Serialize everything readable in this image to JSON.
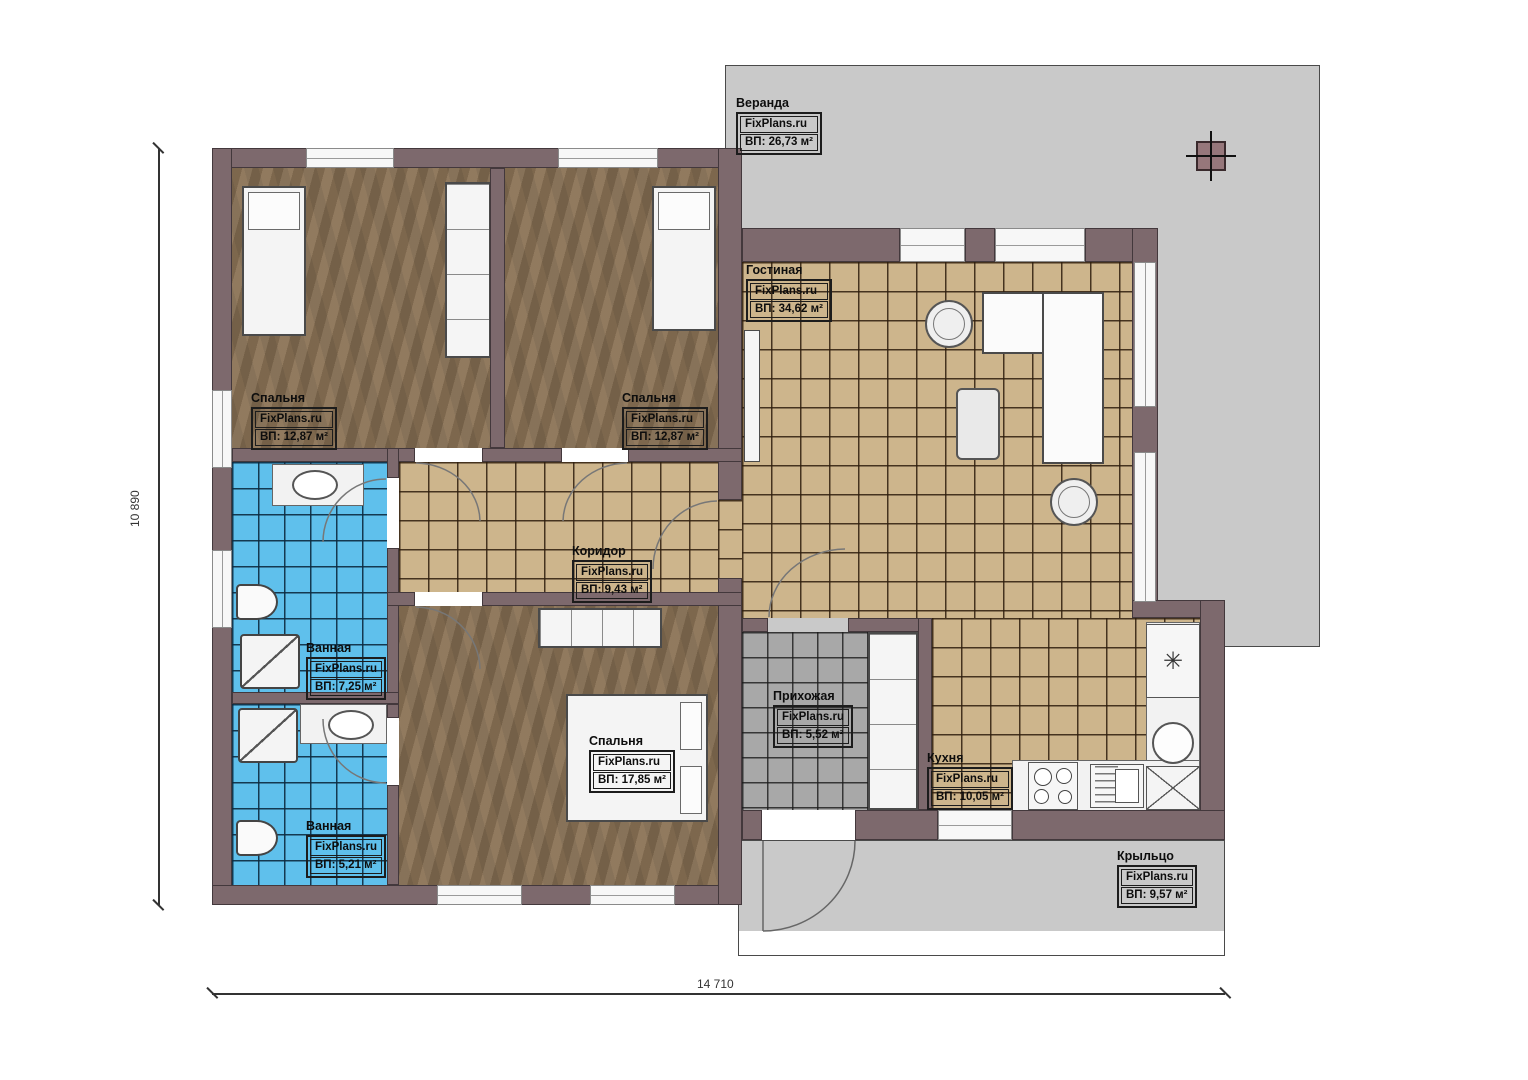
{
  "branding": "FixPlans.ru",
  "rooms": [
    {
      "id": "veranda",
      "name": "Веранда",
      "area": "ВП: 26,73 м²"
    },
    {
      "id": "living",
      "name": "Гостиная",
      "area": "ВП: 34,62 м²"
    },
    {
      "id": "bedroom1",
      "name": "Спальня",
      "area": "ВП: 12,87 м²"
    },
    {
      "id": "bedroom2",
      "name": "Спальня",
      "area": "ВП: 12,87 м²"
    },
    {
      "id": "corridor",
      "name": "Коридор",
      "area": "ВП: 9,43 м²"
    },
    {
      "id": "bathroom1",
      "name": "Ванная",
      "area": "ВП: 7,25 м²"
    },
    {
      "id": "bedroom3",
      "name": "Спальня",
      "area": "ВП: 17,85 м²"
    },
    {
      "id": "bathroom2",
      "name": "Ванная",
      "area": "ВП: 5,21 м²"
    },
    {
      "id": "hallway",
      "name": "Прихожая",
      "area": "ВП: 5,52 м²"
    },
    {
      "id": "kitchen",
      "name": "Кухня",
      "area": "ВП: 10,05 м²"
    },
    {
      "id": "porch",
      "name": "Крыльцо",
      "area": "ВП: 9,57 м²"
    }
  ],
  "dimensions": {
    "height_label": "10 890",
    "width_label": "14 710"
  },
  "icons": {
    "fridge_snowflake": "✳"
  },
  "colors": {
    "wall": "#7d696d",
    "wood_floor": "#8b7356",
    "tile_beige": "#cdb58c",
    "tile_blue": "#5fc0ec",
    "tile_gray_hall": "#a8a8a8",
    "veranda_gray": "#c9c9c9",
    "furniture_white": "#f4f4f4",
    "label_text": "#0d0d0d"
  }
}
